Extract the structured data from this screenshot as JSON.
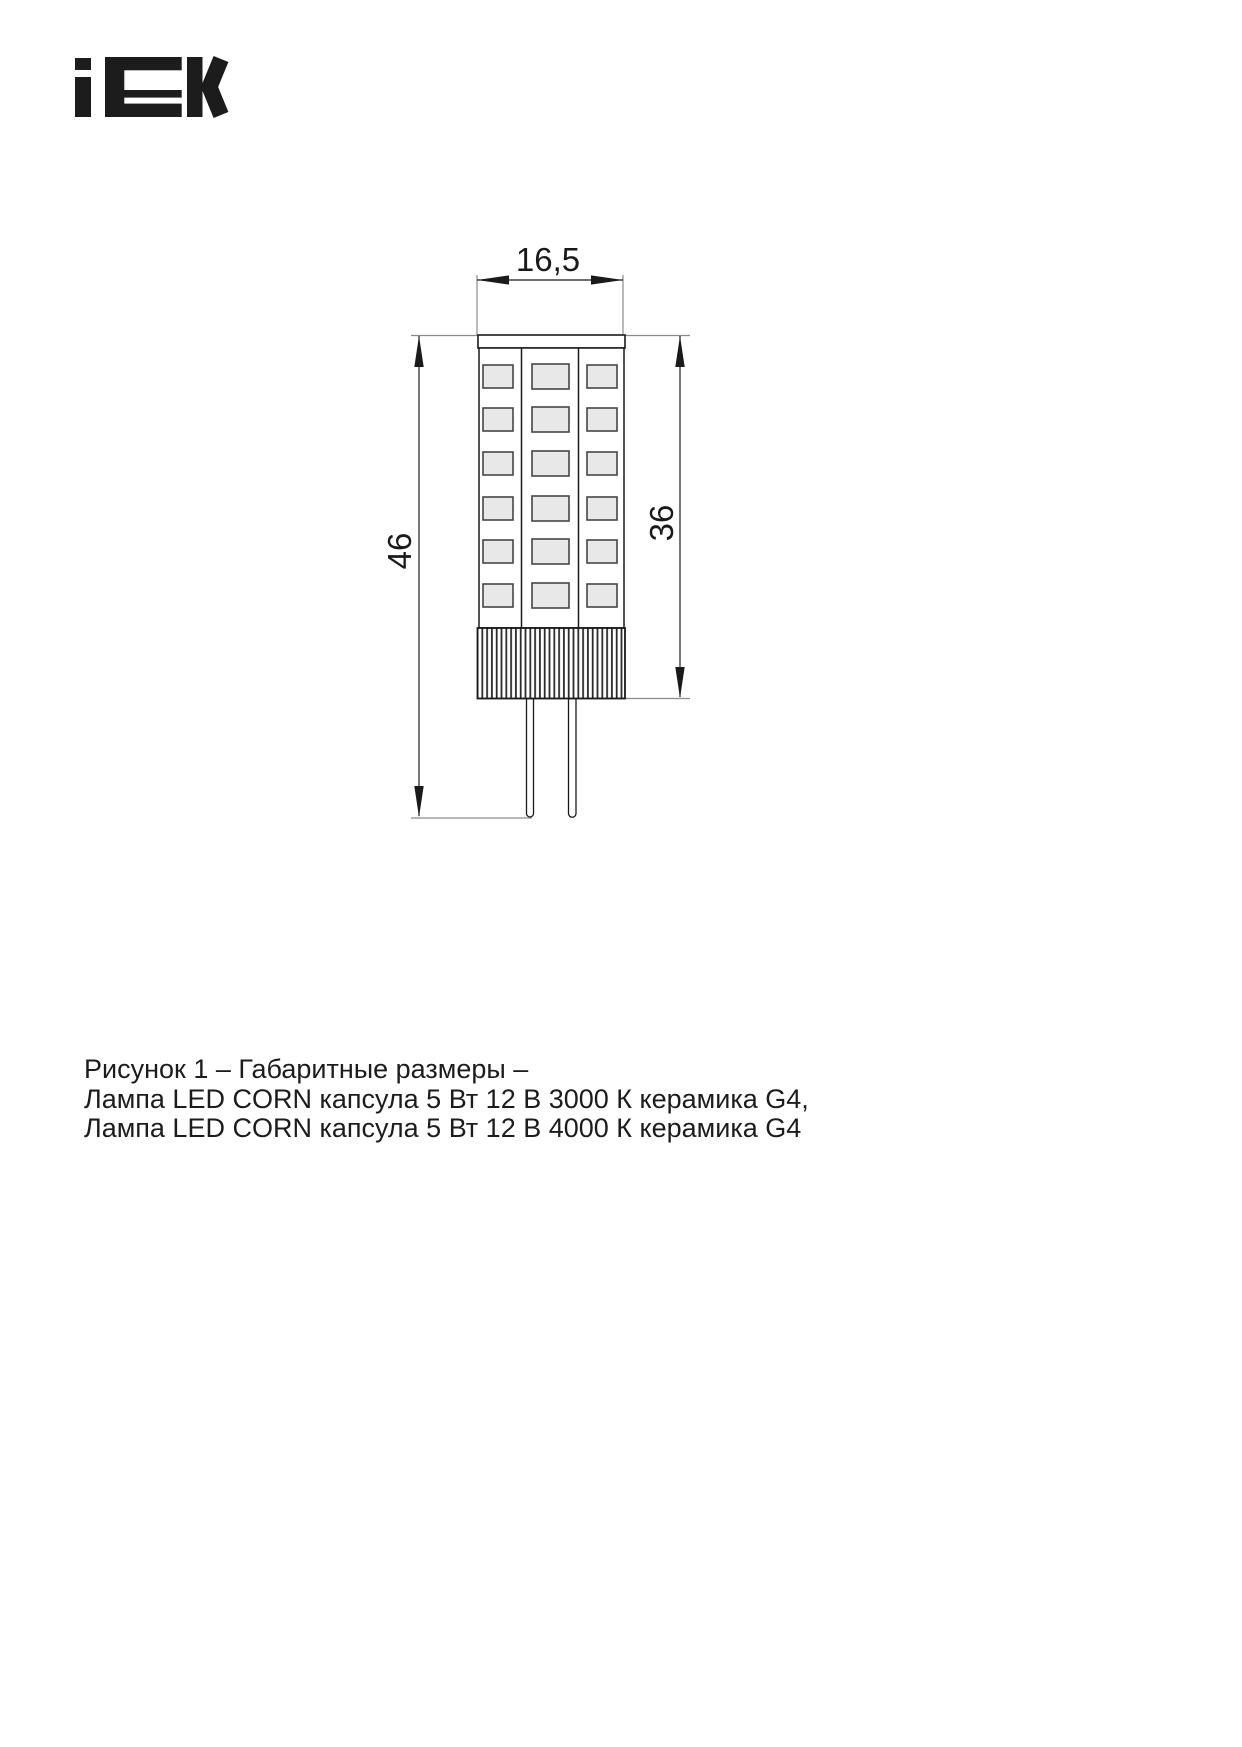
{
  "page": {
    "background": "#ffffff"
  },
  "logo": {
    "brand": "IEK",
    "color": "#1c1c1c"
  },
  "figure": {
    "dimension_labels": {
      "width": "16,5",
      "overall_height": "46",
      "body_height": "36"
    },
    "lamp": {
      "led_rows": 6,
      "led_columns": 3,
      "colors": {
        "outline": "#1a1a1a",
        "led_fill": "#e8e8e8",
        "extension_line": "#8a8a8a"
      }
    }
  },
  "caption": {
    "lines": [
      "Рисунок 1 – Габаритные размеры –",
      "Лампа LED CORN капсула 5 Вт 12 В 3000 К керамика G4,",
      "Лампа LED CORN капсула 5 Вт 12 В 4000 К керамика G4"
    ]
  }
}
